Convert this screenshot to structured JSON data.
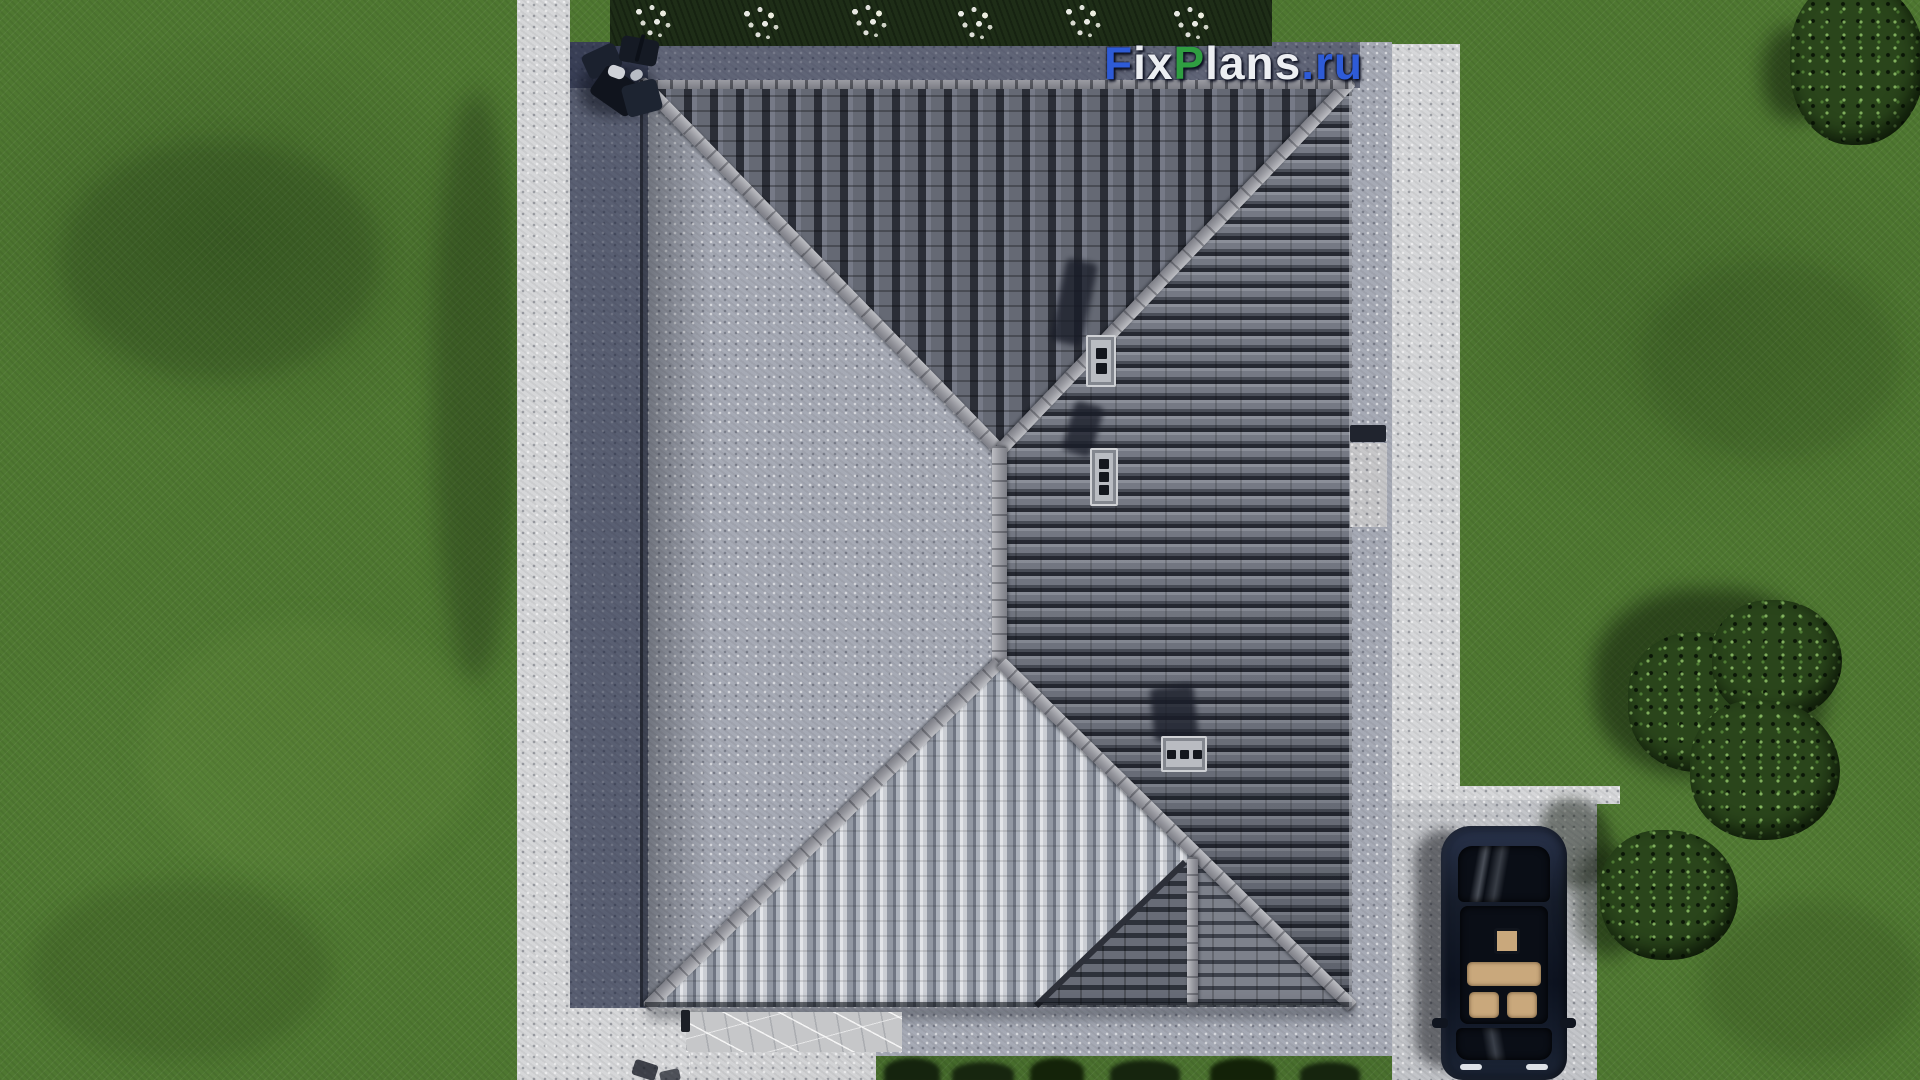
{
  "watermark": {
    "full_text": "FixPlans.ru",
    "segments": [
      {
        "text": "F",
        "color": "#2e5bd7"
      },
      {
        "text": "ix",
        "color": "#eceef2"
      },
      {
        "text": "P",
        "color": "#2f9e41"
      },
      {
        "text": "lans",
        "color": "#eceef2"
      },
      {
        "text": ".ru",
        "color": "#2e5bd7"
      }
    ]
  },
  "scene": {
    "type": "aerial-3d-architectural-render",
    "view": "top-down bird's eye view of a house hip roof with surrounding yard",
    "palette": {
      "grass": "#4f7831",
      "roof_tile_light": "#9296a0",
      "roof_tile_dark": "#2b2e37",
      "roof_south_highlight": "#e3e5e9",
      "ridge_cap": "#a8a9b0",
      "pavement_shaded": "#5a6076",
      "pavement_lit": "#a6aab5",
      "walkway_bright": "#d6d7d9",
      "driveway": "#c3c5c9",
      "flower_bed": "#1e2d17",
      "car_body": "#141a26",
      "car_seats": "#c9a87c",
      "chimney": "#b9bcc2"
    },
    "elements": [
      "hip roof with four slopes and central ridge",
      "three chimneys with dark flue openings and cast shadows",
      "bright ribbed south slope triangle with porch sub-gable",
      "concrete apron around house, left side in building shadow",
      "white perimeter walkways",
      "entrance steps with marble slab at bottom",
      "flower bed with white blossoms along top edge",
      "patio furniture group at top-left roof corner",
      "driveway with dark parked car seen from above, beige interior through glass roof",
      "trees and bushes on right side casting shadows",
      "FixPlans.ru watermark"
    ]
  }
}
